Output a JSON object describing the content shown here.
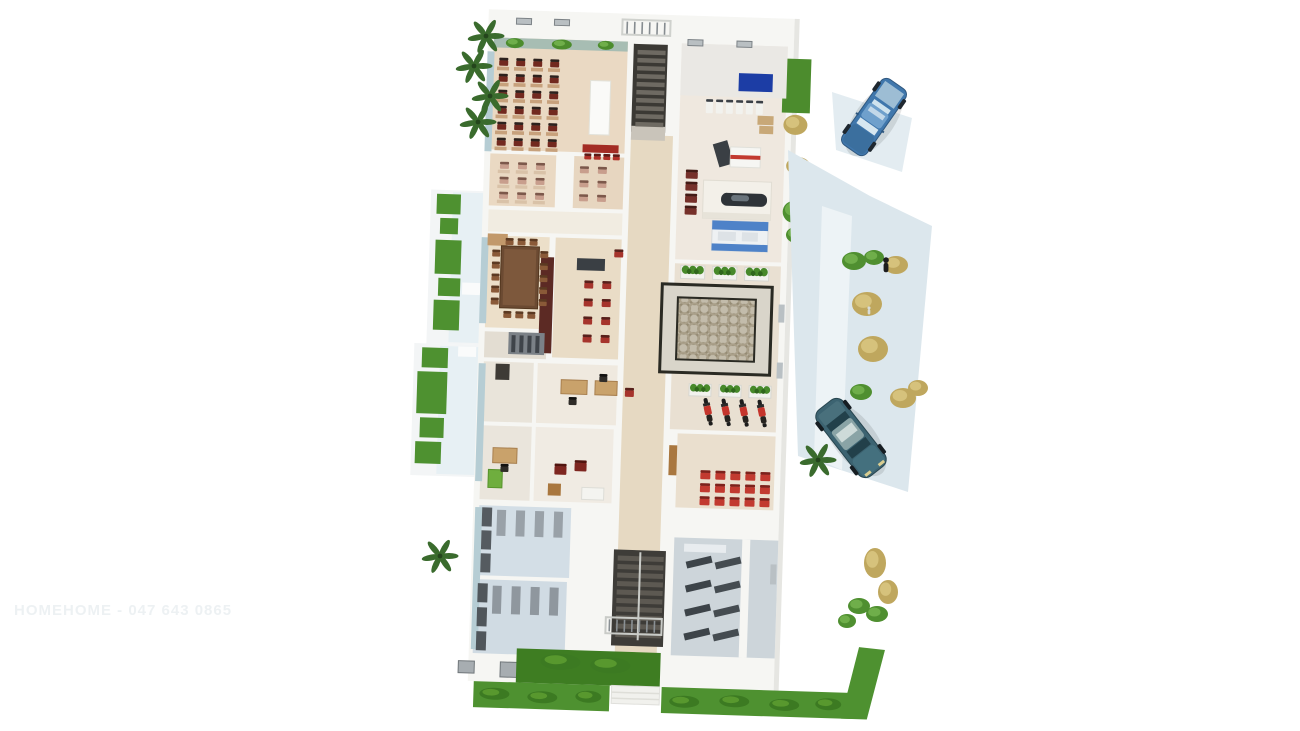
{
  "scene": {
    "description": "3D cutaway floor plan render of a single-storey building viewed from above",
    "watermark_text": "HOMEHOME - 047 643 0865",
    "palette": {
      "background": "#ffffff",
      "floor_warm": "#ead9c3",
      "floor_cool": "#d3dee6",
      "grass": "#4e9130",
      "grass_dark": "#3e7d22",
      "walkway": "#e7f0f4",
      "driveway": "#dce7ed",
      "counter_blue": "#4e82c8",
      "sign_navy": "#1c3da5",
      "chair_red": "#c23a30",
      "table_brown": "#6b4a32",
      "maroon_wall": "#5c2a24",
      "car_blue": "#4077ac",
      "car_teal": "#3c6371",
      "stair_dark": "#3b3934",
      "wall_white": "#f6f6f3"
    },
    "rooms": [
      {
        "name": "classroom-large",
        "floor": "#ead9c3"
      },
      {
        "name": "classroom-small-1",
        "floor": "#ead9c3"
      },
      {
        "name": "classroom-small-2",
        "floor": "#e7d6c0"
      },
      {
        "name": "meeting-room",
        "floor": "#ecdfc9"
      },
      {
        "name": "waiting-bar-area",
        "floor": "#e9dcc6"
      },
      {
        "name": "office-1",
        "floor": "#efe9df"
      },
      {
        "name": "office-2",
        "floor": "#eae5dc"
      },
      {
        "name": "lounge",
        "floor": "#f0ebe3"
      },
      {
        "name": "storage-room-1",
        "floor": "#d3dee6"
      },
      {
        "name": "storage-room-2",
        "floor": "#d0dbe3"
      },
      {
        "name": "gym-service-hall",
        "floor": "#efe8df"
      },
      {
        "name": "courtyard-hall",
        "floor": "#e9e0d2"
      },
      {
        "name": "red-chair-room",
        "floor": "#eadfce"
      },
      {
        "name": "toilets",
        "floor": "#cdd5da"
      },
      {
        "name": "corridor",
        "floor": "#e6d9c2"
      }
    ],
    "vehicles": [
      {
        "name": "blue-pickup-truck",
        "color": "#4077ac"
      },
      {
        "name": "dark-teal-sedan",
        "color": "#3c6371"
      }
    ],
    "stamps": [
      {
        "layer": "glass-layer",
        "shape": "rect",
        "name": "glass-wall",
        "fill": "#b6cdd4",
        "items": [
          [
            488,
            56,
            7,
            100
          ],
          [
            488,
            242,
            7,
            86
          ],
          [
            489,
            368,
            7,
            118
          ],
          [
            490,
            512,
            7,
            142
          ]
        ]
      },
      {
        "layer": "vent-layer",
        "shape": "window",
        "name": "roof-vent",
        "fill": "#b9bfc2",
        "stroke": "#7d8387",
        "items": [
          [
            516,
            22,
            15,
            6
          ],
          [
            554,
            22,
            15,
            6
          ],
          [
            688,
            38,
            15,
            6
          ],
          [
            737,
            38,
            15,
            6
          ]
        ]
      },
      {
        "layer": "window-layer",
        "shape": "window",
        "name": "wall-window",
        "fill": "#a7adb1",
        "stroke": "#70767a",
        "items": [
          [
            520,
            666,
            22,
            15
          ],
          [
            564,
            663,
            20,
            17
          ],
          [
            478,
            666,
            16,
            12
          ]
        ]
      },
      {
        "layer": "slit-layer",
        "shape": "rect",
        "name": "wall-window-slit",
        "fill": "#b9c0c4",
        "items": [
          [
            787,
            300,
            6,
            18
          ],
          [
            787,
            358,
            6,
            16
          ],
          [
            787,
            560,
            6,
            20
          ]
        ]
      },
      {
        "layer": "classa-furniture",
        "shape": "rect",
        "name": "student-desk",
        "fill": "#c7a17c",
        "x": 498,
        "y": 71,
        "cols": 4,
        "rows": 6,
        "dx": 17,
        "dy": 16,
        "w": 12,
        "h": 3.6
      },
      {
        "layer": "classa-furniture",
        "shape": "chair",
        "name": "student-chair",
        "fill": "#72291f",
        "fill2": "#2c211d",
        "x": 500,
        "y": 62,
        "cols": 4,
        "rows": 6,
        "dx": 17,
        "dy": 16,
        "w": 9,
        "h": 8
      },
      {
        "layer": "classa-furniture",
        "shape": "chair",
        "name": "front-red-chair",
        "fill": "#b03028",
        "fill2": "#5e1b16",
        "x": 588,
        "y": 155,
        "cols": 4,
        "rows": 1,
        "dx": 9.5,
        "w": 7,
        "h": 6
      },
      {
        "layer": "classb-furniture",
        "shape": "rect",
        "name": "student-desk",
        "fill": "#d9c2a8",
        "x": 502,
        "y": 174,
        "cols": 3,
        "rows": 3,
        "dx": 18,
        "dy": 15,
        "w": 12,
        "h": 3.4
      },
      {
        "layer": "classb-furniture",
        "shape": "chair",
        "name": "student-chair-pink",
        "fill": "#c89e8d",
        "fill2": "#7c584b",
        "x": 504,
        "y": 166,
        "cols": 3,
        "rows": 3,
        "dx": 18,
        "dy": 15,
        "w": 9,
        "h": 7
      },
      {
        "layer": "classb-furniture",
        "shape": "chair",
        "name": "student-chair-pink",
        "fill": "#c89e8d",
        "fill2": "#7c584b",
        "x": 584,
        "y": 168,
        "cols": 2,
        "rows": 3,
        "dx": 18,
        "dy": 14,
        "w": 9,
        "h": 7
      },
      {
        "layer": "meeting-furniture",
        "shape": "chair",
        "name": "meeting-chair",
        "fill": "#8a5a38",
        "fill2": "#5c3a22",
        "x": 499,
        "y": 254,
        "cols": 1,
        "rows": 5,
        "dy": 12,
        "w": 8,
        "h": 7
      },
      {
        "layer": "meeting-furniture",
        "shape": "chair",
        "name": "meeting-chair",
        "fill": "#8a5a38",
        "fill2": "#5c3a22",
        "x": 547,
        "y": 254,
        "cols": 1,
        "rows": 5,
        "dy": 12,
        "w": 8,
        "h": 7
      },
      {
        "layer": "meeting-furniture",
        "shape": "chair",
        "name": "meeting-chair",
        "fill": "#8a5a38",
        "fill2": "#5c3a22",
        "x": 512,
        "y": 242,
        "cols": 3,
        "rows": 1,
        "dx": 12,
        "w": 8,
        "h": 7
      },
      {
        "layer": "meeting-furniture",
        "shape": "chair",
        "name": "meeting-chair",
        "fill": "#8a5a38",
        "fill2": "#5c3a22",
        "x": 512,
        "y": 315,
        "cols": 3,
        "rows": 1,
        "dx": 12,
        "w": 8,
        "h": 7
      },
      {
        "layer": "bar-furniture",
        "shape": "chair",
        "name": "waiting-chair-red",
        "fill": "#a6342c",
        "fill2": "#58201b",
        "x": 592,
        "y": 282,
        "cols": 2,
        "rows": 4,
        "dx": 18,
        "dy": 18,
        "w": 9,
        "h": 8
      },
      {
        "layer": "bar-furniture",
        "shape": "chair",
        "name": "waiting-chair-red",
        "fill": "#a6342c",
        "fill2": "#58201b",
        "x": 621,
        "y": 250,
        "cols": 1,
        "rows": 1,
        "w": 9,
        "h": 8
      },
      {
        "layer": "archive-stripes",
        "shape": "rect",
        "name": "shelf-stripe",
        "fill": "#3f444a",
        "x": 521,
        "y": 339,
        "cols": 4,
        "rows": 1,
        "dx": 8,
        "w": 4,
        "h": 17
      },
      {
        "layer": "office-furniture",
        "shape": "chair",
        "name": "office-chair",
        "fill": "#2f2c28",
        "fill2": "#121110",
        "x": 580,
        "y": 399,
        "cols": 1,
        "rows": 1,
        "w": 8,
        "h": 8
      },
      {
        "layer": "office-furniture",
        "shape": "chair",
        "name": "office-chair",
        "fill": "#2f2c28",
        "fill2": "#121110",
        "x": 610,
        "y": 375,
        "cols": 1,
        "rows": 1,
        "w": 8,
        "h": 8
      },
      {
        "layer": "office-furniture",
        "shape": "chair",
        "name": "corridor-chair-red",
        "fill": "#a6342c",
        "fill2": "#58201b",
        "x": 636,
        "y": 388,
        "cols": 1,
        "rows": 1,
        "w": 9,
        "h": 9
      },
      {
        "layer": "office-furniture",
        "shape": "chair",
        "name": "office-chair",
        "fill": "#2f2c28",
        "fill2": "#121110",
        "x": 514,
        "y": 468,
        "cols": 1,
        "rows": 1,
        "w": 8,
        "h": 8
      },
      {
        "layer": "office-furniture",
        "shape": "chair",
        "name": "lounge-armchair",
        "fill": "#7e2620",
        "fill2": "#51140f",
        "items": [
          [
            568,
            466,
            12,
            11
          ],
          [
            588,
            462,
            12,
            11
          ]
        ]
      },
      {
        "layer": "storage-furniture",
        "shape": "rect",
        "name": "storage-shelf",
        "fill": "#99a1a8",
        "x": 512,
        "y": 514,
        "cols": 4,
        "rows": 1,
        "dx": 19,
        "w": 9,
        "h": 26
      },
      {
        "layer": "storage-furniture",
        "shape": "rect",
        "name": "storage-cabinet",
        "fill": "#555b60",
        "x": 497,
        "y": 512,
        "cols": 1,
        "rows": 3,
        "dy": 23,
        "w": 10,
        "h": 19
      },
      {
        "layer": "storage-furniture",
        "shape": "rect",
        "name": "storage-shelf",
        "fill": "#8f979e",
        "x": 510,
        "y": 590,
        "cols": 4,
        "rows": 1,
        "dx": 19,
        "w": 9,
        "h": 28
      },
      {
        "layer": "storage-furniture",
        "shape": "rect",
        "name": "storage-cabinet",
        "fill": "#50565b",
        "x": 495,
        "y": 588,
        "cols": 1,
        "rows": 3,
        "dy": 24,
        "w": 10,
        "h": 19
      },
      {
        "layer": "gym-furniture",
        "shape": "chair",
        "name": "wall-fixture",
        "fill": "#f2f2ee",
        "fill2": "#3a3f45",
        "x": 708,
        "y": 97,
        "cols": 6,
        "rows": 1,
        "dx": 10,
        "w": 7,
        "h": 14
      },
      {
        "layer": "gym-furniture",
        "shape": "rect",
        "name": "storage-box",
        "fill": "#c8a878",
        "items": [
          [
            760,
            112,
            16,
            9
          ],
          [
            762,
            122,
            14,
            8
          ]
        ]
      },
      {
        "layer": "gym-furniture",
        "shape": "chair",
        "name": "waiting-chair",
        "fill": "#76302a",
        "fill2": "#431b16",
        "x": 690,
        "y": 168,
        "cols": 1,
        "rows": 4,
        "dy": 12,
        "w": 12,
        "h": 9
      },
      {
        "layer": "planter-layer",
        "shape": "planter",
        "name": "planter-box",
        "x": 688,
        "y": 264,
        "cols": 3,
        "rows": 1,
        "dx": 32,
        "w": 24,
        "h": 13
      },
      {
        "layer": "planter-layer",
        "shape": "planter",
        "name": "planter-box",
        "x": 700,
        "y": 382,
        "cols": 3,
        "rows": 1,
        "dx": 30,
        "w": 22,
        "h": 12
      },
      {
        "layer": "scooter-layer",
        "shape": "scooter",
        "name": "scooter",
        "x": 712,
        "y": 399,
        "cols": 4,
        "rows": 1,
        "dx": 18,
        "w": 10,
        "h": 24
      },
      {
        "layer": "classc-furniture",
        "shape": "chair",
        "name": "red-chair",
        "fill": "#c23a30",
        "fill2": "#7d221c",
        "x": 714,
        "y": 468,
        "cols": 5,
        "rows": 3,
        "dx": 15,
        "dy": 13,
        "w": 10,
        "h": 9
      },
      {
        "layer": "toilet-furniture",
        "shape": "rect",
        "name": "toilet-stall",
        "fill": "#3d4449",
        "rot": -15,
        "x": 702,
        "y": 560,
        "cols": 1,
        "rows": 4,
        "dy": 24,
        "w": 26,
        "h": 7
      },
      {
        "layer": "toilet-furniture",
        "shape": "rect",
        "name": "toilet-stall",
        "fill": "#454c51",
        "rot": -15,
        "x": 731,
        "y": 560,
        "cols": 1,
        "rows": 4,
        "dy": 24,
        "w": 26,
        "h": 7
      },
      {
        "layer": "stairs-top-steps",
        "shape": "rect",
        "name": "stair-step",
        "fill": "#6e6a62",
        "x": 638,
        "y": 50,
        "cols": 1,
        "rows": 10,
        "dy": 8,
        "w": 28,
        "h": 4.5
      },
      {
        "layer": "stairs-bottom-steps",
        "shape": "rect",
        "name": "stair-step",
        "fill": "#5d5952",
        "x": 634,
        "y": 556,
        "cols": 1,
        "rows": 10,
        "dy": 8.5,
        "w": 46,
        "h": 5
      },
      {
        "layer": "railing-top-bars",
        "shape": "rect",
        "name": "railing-bar",
        "fill": "#868c90",
        "x": 626,
        "y": 22,
        "cols": 6,
        "rows": 1,
        "dx": 7.5,
        "w": 1.6,
        "h": 12
      },
      {
        "layer": "railing-bottom-bars",
        "shape": "rect",
        "name": "railing-bar",
        "fill": "#8a9094",
        "x": 627,
        "y": 620,
        "cols": 7,
        "rows": 1,
        "dx": 7.5,
        "w": 1.6,
        "h": 12
      },
      {
        "layer": "grass-left-layer",
        "shape": "rect",
        "name": "grass-patch",
        "fill": "#4e9130",
        "items": [
          [
            442,
            200,
            24,
            20
          ],
          [
            446,
            224,
            18,
            16
          ],
          [
            442,
            246,
            26,
            34
          ],
          [
            446,
            284,
            22,
            18
          ],
          [
            442,
            306,
            26,
            30
          ],
          [
            432,
            354,
            26,
            20
          ],
          [
            428,
            378,
            30,
            42
          ],
          [
            432,
            424,
            24,
            20
          ],
          [
            428,
            448,
            26,
            22
          ]
        ]
      },
      {
        "layer": "grass-tuft-layer",
        "shape": "bush",
        "name": "grass-tuft",
        "fill": "#3c7a22",
        "fill2": "#58982e",
        "items": [
          [
            500,
            692,
            30,
            12
          ],
          [
            548,
            694,
            30,
            12
          ],
          [
            596,
            692,
            26,
            12
          ],
          [
            690,
            694,
            30,
            12
          ],
          [
            740,
            692,
            30,
            12
          ],
          [
            790,
            694,
            30,
            12
          ],
          [
            836,
            692,
            26,
            12
          ],
          [
            560,
            656,
            40,
            16
          ],
          [
            610,
            658,
            40,
            16
          ]
        ]
      },
      {
        "layer": "building-bush-layer",
        "shape": "bush",
        "name": "window-plant",
        "fill": "#4c8c2d",
        "fill2": "#6fae4a",
        "items": [
          [
            506,
            42,
            18,
            10
          ],
          [
            552,
            42,
            20,
            10
          ],
          [
            598,
            42,
            16,
            9
          ]
        ]
      },
      {
        "layer": "building-bush-layer",
        "shape": "bush",
        "name": "shrub-green",
        "fill": "#4f8f30",
        "fill2": "#6fae4a",
        "items": [
          [
            788,
            196,
            22,
            22
          ],
          [
            792,
            222,
            20,
            16
          ]
        ]
      },
      {
        "layer": "building-bush-layer",
        "shape": "bush",
        "name": "shrub-tan",
        "fill": "#bfa75e",
        "fill2": "#d6c27c",
        "items": [
          [
            786,
            110,
            24,
            20
          ],
          [
            790,
            152,
            24,
            18
          ]
        ]
      },
      {
        "layer": "bush-layer",
        "shape": "bush",
        "name": "shrub-green",
        "fill": "#4f8f30",
        "fill2": "#6fae4a",
        "items": [
          [
            842,
            252,
            24,
            18
          ],
          [
            864,
            250,
            20,
            15
          ],
          [
            850,
            384,
            22,
            16
          ],
          [
            848,
            598,
            22,
            16
          ],
          [
            866,
            606,
            22,
            16
          ],
          [
            838,
            614,
            18,
            14
          ]
        ]
      },
      {
        "layer": "bush-layer",
        "shape": "bush",
        "name": "shrub-tan",
        "fill": "#bfa75e",
        "fill2": "#d6c27c",
        "items": [
          [
            884,
            256,
            24,
            18
          ],
          [
            852,
            292,
            30,
            24
          ],
          [
            858,
            336,
            30,
            26
          ],
          [
            890,
            388,
            26,
            20
          ],
          [
            908,
            380,
            20,
            16
          ],
          [
            864,
            548,
            22,
            30
          ],
          [
            878,
            580,
            20,
            24
          ]
        ]
      },
      {
        "layer": "palm-layer",
        "shape": "palm",
        "name": "palm-plant",
        "fill": "#3a6b2d",
        "items": [
          [
            486,
            36
          ],
          [
            474,
            66
          ],
          [
            490,
            96
          ],
          [
            478,
            122
          ],
          [
            440,
            556
          ],
          [
            818,
            460
          ]
        ]
      },
      {
        "layer": "people-layer",
        "shape": "person",
        "name": "person",
        "fill": "#1c1c1e",
        "h": 11,
        "items": [
          [
            886,
            264
          ]
        ]
      },
      {
        "layer": "people-layer",
        "shape": "person",
        "name": "bird",
        "fill": "#d8dcd8",
        "h": 6,
        "items": [
          [
            869,
            310
          ]
        ]
      }
    ]
  }
}
